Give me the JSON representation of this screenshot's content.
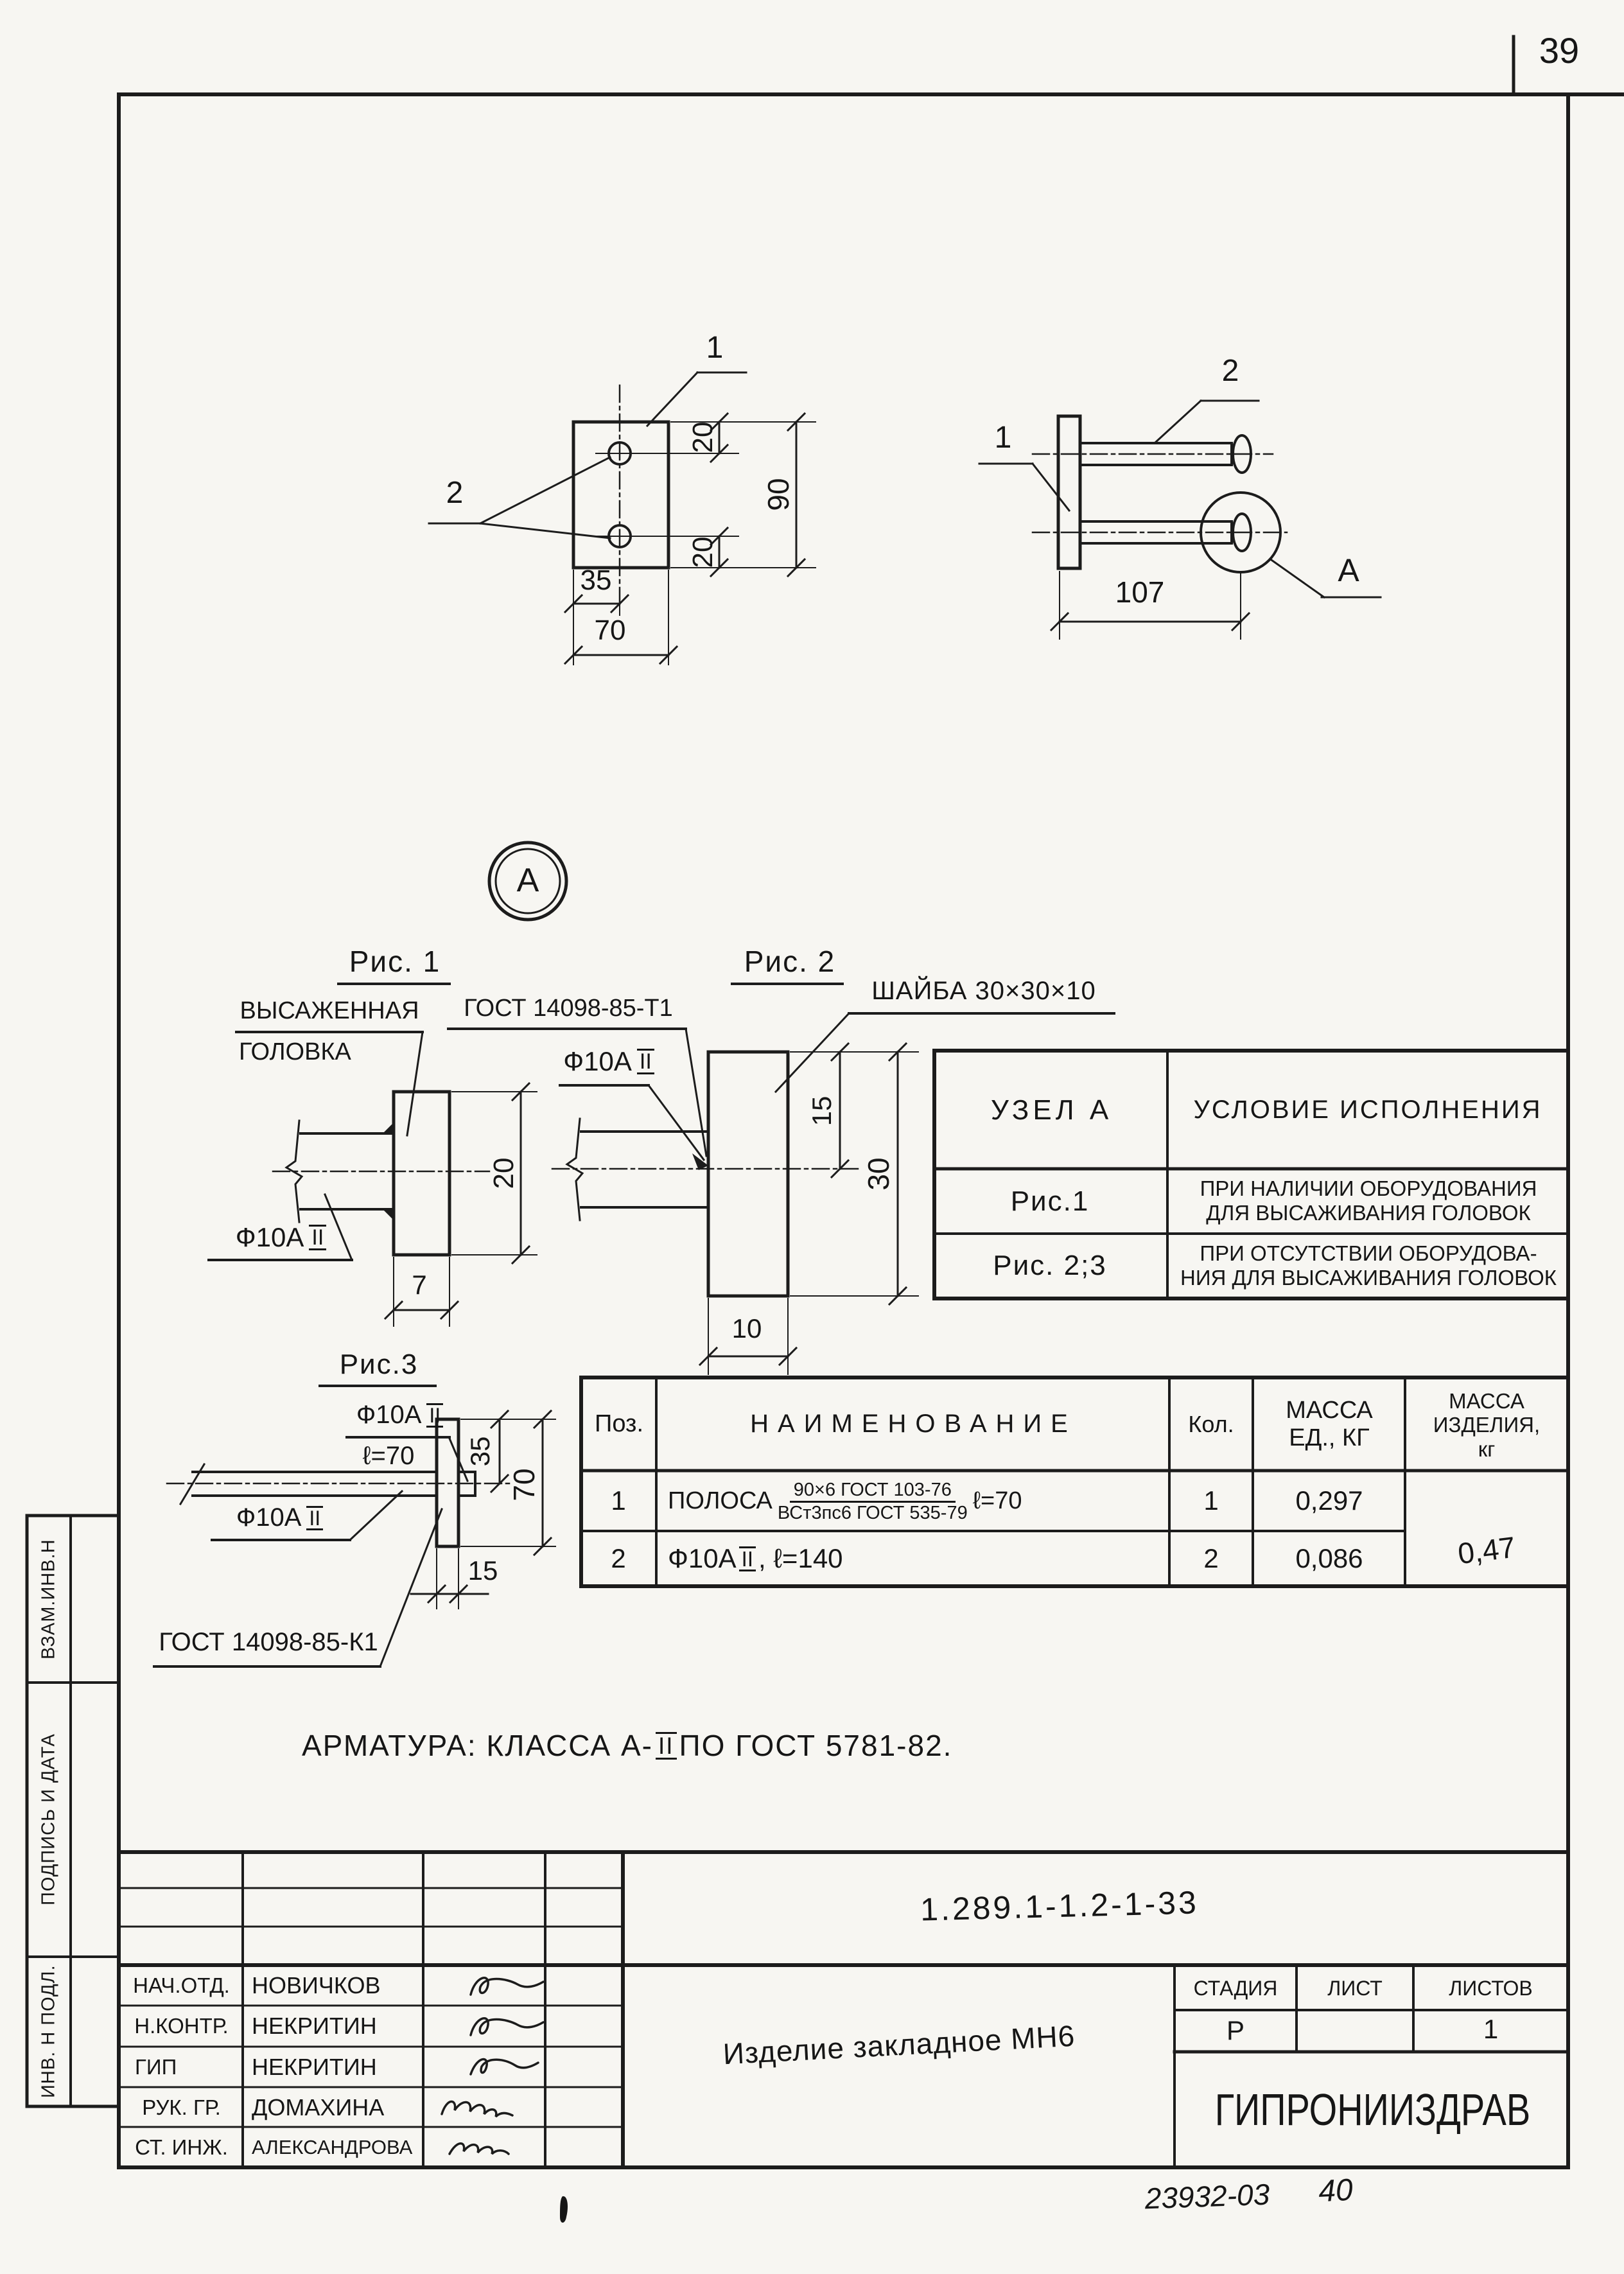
{
  "page": {
    "sheet_number": "39",
    "footer_code": "23932-03",
    "footer_page": "40"
  },
  "front_view": {
    "pos1": "1",
    "pos2": "2",
    "dim_top_offset": "20",
    "dim_bottom_offset": "20",
    "dim_height": "90",
    "dim_hole_offset": "35",
    "dim_width": "70"
  },
  "side_view": {
    "pos1": "1",
    "pos2": "2",
    "dim_length": "107",
    "detail_label": "А"
  },
  "detail_marker": {
    "label": "А"
  },
  "fig1": {
    "title": "Рис. 1",
    "callout_upper": "ВЫСАЖЕННАЯ",
    "callout_lower": "ГОЛОВКА",
    "weld_gost": "ГОСТ 14098-85-Т1",
    "rebar_prefix": "Ф10А",
    "rebar_class": "II",
    "dim_head_height": "20",
    "dim_head_width": "7"
  },
  "fig2": {
    "title": "Рис. 2",
    "washer_label": "ШАЙБА 30×30×10",
    "rebar_prefix": "Ф10А",
    "rebar_class": "II",
    "dim_half": "15",
    "dim_washer": "30",
    "dim_thickness": "10"
  },
  "fig3": {
    "title": "Рис.3",
    "rebar_top_prefix": "Ф10А",
    "rebar_top_class": "II",
    "rebar_top_length": "ℓ=70",
    "rebar_side_prefix": "Ф10А",
    "rebar_side_class": "II",
    "weld_gost": "ГОСТ 14098-85-К1",
    "dim_half": "35",
    "dim_height": "70",
    "dim_thickness": "15"
  },
  "node_table": {
    "col_node": "УЗЕЛ А",
    "col_condition": "УСЛОВИЕ ИСПОЛНЕНИЯ",
    "rows": [
      {
        "node": "Рис.1",
        "condition": "ПРИ НАЛИЧИИ ОБОРУДОВАНИЯ\nДЛЯ ВЫСАЖИВАНИЯ ГОЛОВОК"
      },
      {
        "node": "Рис. 2;3",
        "condition": "ПРИ ОТСУТСТВИИ ОБОРУДОВА-\nНИЯ ДЛЯ ВЫСАЖИВАНИЯ ГОЛОВОК"
      }
    ]
  },
  "parts_table": {
    "col_pos": "Поз.",
    "col_name": "НАИМЕНОВАНИЕ",
    "col_qty": "Кол.",
    "col_mass_unit": "МАССА\nЕД., КГ",
    "col_mass_total": "МАССА\nИЗДЕЛИЯ,\nкг",
    "rows": [
      {
        "pos": "1",
        "name_prefix": "ПОЛОСА",
        "frac_top": "90×6  ГОСТ 103-76",
        "frac_bottom": "ВСт3пс6 ГОСТ 535-79",
        "name_suffix": "ℓ=70",
        "qty": "1",
        "mass": "0,297"
      },
      {
        "pos": "2",
        "name_prefix": "Ф10А",
        "name_class": "II",
        "name_suffix": ", ℓ=140",
        "qty": "2",
        "mass": "0,086"
      }
    ],
    "mass_total": "0,47"
  },
  "note": {
    "prefix": "АРМАТУРА:  КЛАССА  А-",
    "roman": "II",
    "suffix": "  ПО  ГОСТ 5781-82."
  },
  "title_block": {
    "doc_number": "1.289.1-1.2-1-33",
    "product_name": "Изделие закладное МН6",
    "stage_label": "СТАДИЯ",
    "sheet_label": "ЛИСТ",
    "sheets_label": "ЛИСТОВ",
    "stage": "Р",
    "sheets_total": "1",
    "organization": "ГИПРОНИИЗДРАВ",
    "signature_rows": [
      {
        "role": "НАЧ.ОТД.",
        "name": "НОВИЧКОВ"
      },
      {
        "role": "Н.КОНТР.",
        "name": "НЕКРИТИН"
      },
      {
        "role": "ГИП",
        "name": "НЕКРИТИН"
      },
      {
        "role": "РУК. ГР.",
        "name": "ДОМАХИНА"
      },
      {
        "role": "СТ. ИНЖ.",
        "name": "АЛЕКСАНДРОВА"
      }
    ]
  },
  "side_strip": {
    "cells": [
      "ВЗАМ.ИНВ.Н",
      "ПОДПИСЬ И ДАТА",
      "ИНВ. Н ПОДЛ."
    ]
  }
}
